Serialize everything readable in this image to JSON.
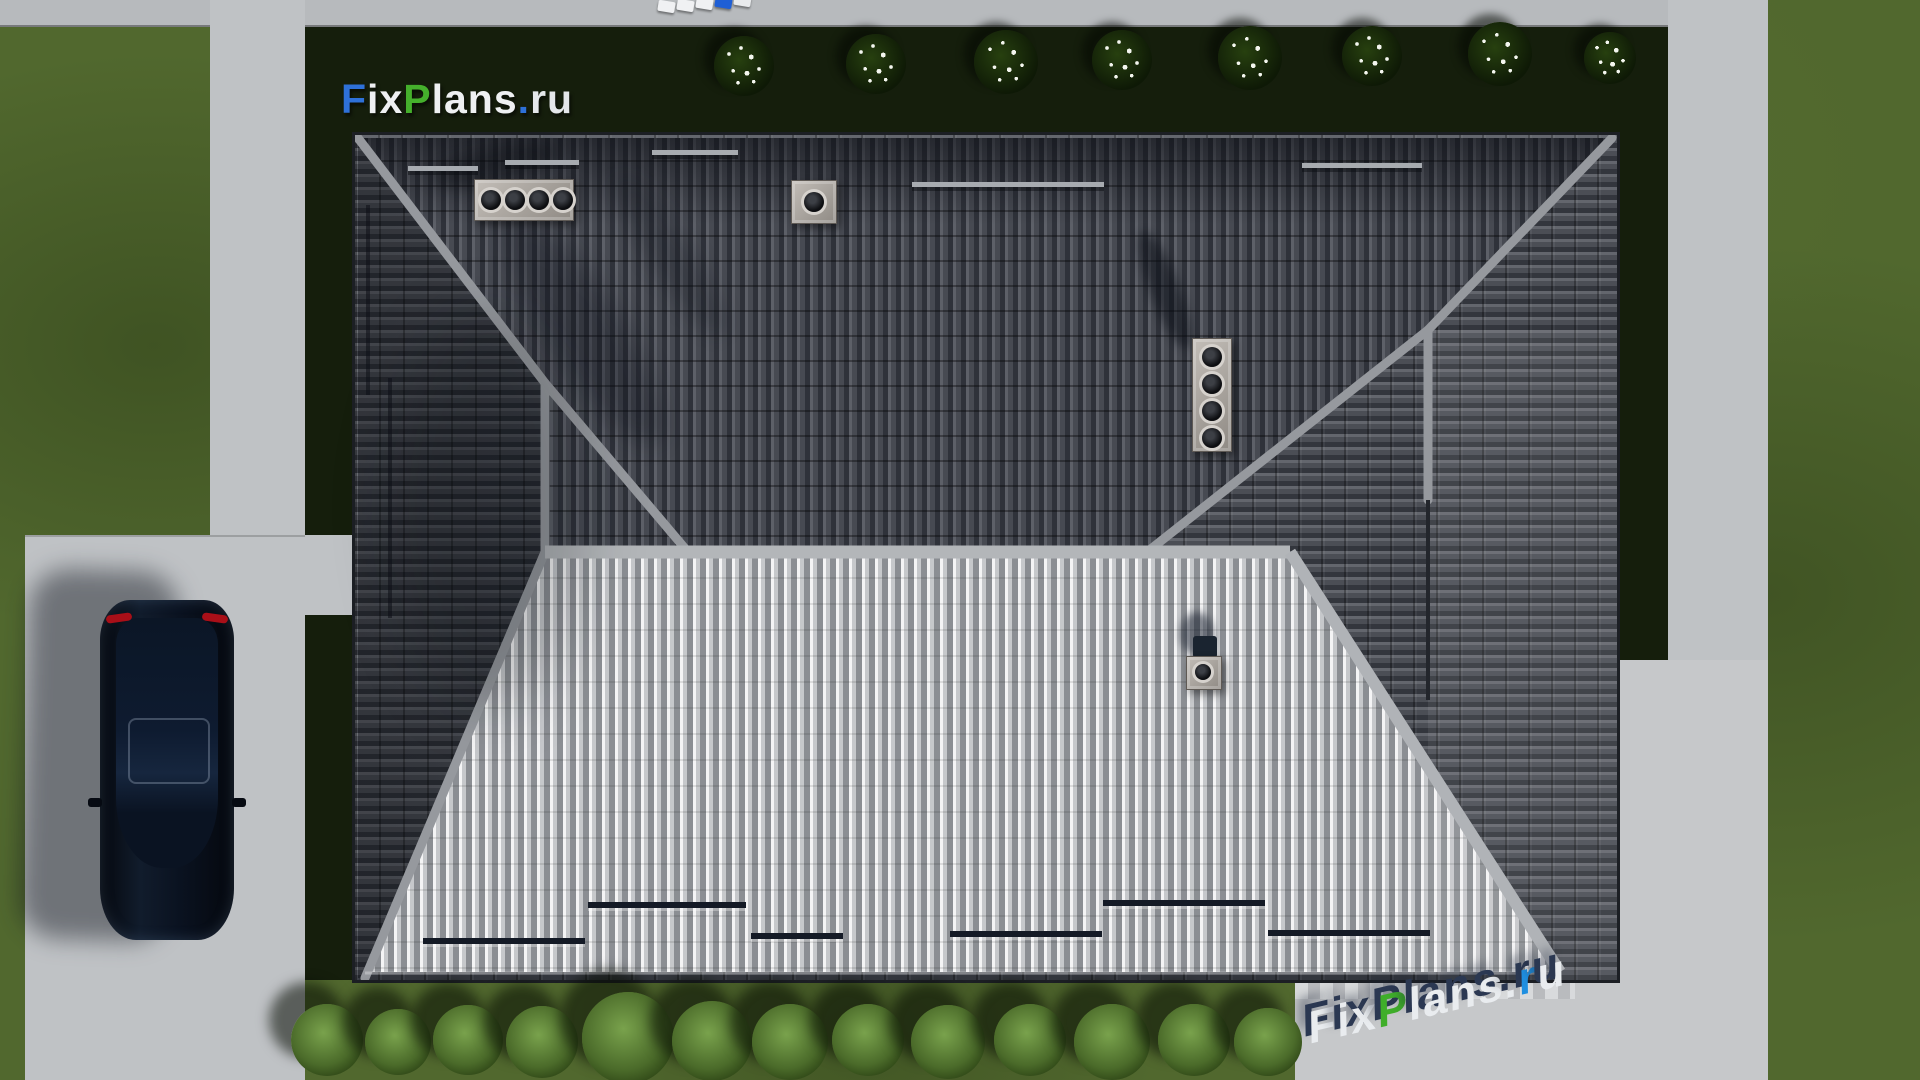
{
  "page": {
    "type": "aerial-architectural-render",
    "subject": "Top-down view of a hip-roof house with yard, driveway, parked car and concrete paths"
  },
  "branding": {
    "site_name": "FixPlans.ru",
    "main_logo": {
      "text": "FixPlans.ru",
      "segments": [
        {
          "text": "F",
          "color": "#2e71d9"
        },
        {
          "text": "ix",
          "color": "#eef0f2"
        },
        {
          "text": "P",
          "color": "#45b02c"
        },
        {
          "text": "lans",
          "color": "#eef0f2"
        },
        {
          "text": ".",
          "color": "#2e71d9"
        },
        {
          "text": "ru",
          "color": "#e4e7ea"
        }
      ]
    },
    "ground_watermark": {
      "text": "FixPlans.ru",
      "segments": [
        {
          "text": "F",
          "color": "#e9ecef"
        },
        {
          "text": "ix",
          "color": "#e9ecef"
        },
        {
          "text": "P",
          "color": "#3fae2a"
        },
        {
          "text": "lans",
          "color": "#e9ecef"
        },
        {
          "text": ".",
          "color": "#e9ecef"
        },
        {
          "text": "r",
          "color": "#1f8fe0"
        },
        {
          "text": "u",
          "color": "#e9ecef"
        }
      ]
    },
    "top_edge_watermark": {
      "blocks": [
        "#f0f1f3",
        "#f0f1f3",
        "#f0f1f3",
        "#1f5fd6",
        "#e8eaec"
      ]
    }
  },
  "palette": {
    "lawn": "#51682e",
    "lawn_shadow": "#151e0c",
    "road": "#b7babd",
    "driveway": "#c0c3c6",
    "patio": "#c6c8ca",
    "roof_dark": "#33363d",
    "roof_light": "#cdcfd2",
    "ridge": "#96999e",
    "car_body": "#0a0f17",
    "taillight": "#a90f18",
    "flowers": "#f4f6ef",
    "hedge": "#4b6b2a"
  },
  "scene": {
    "objects": [
      "hip roof with dark anthracite tiles",
      "sunlit light-grey south roof slope",
      "ridge and valley trims",
      "chimney with four flues",
      "single-flue roof vent",
      "vertical four-flue vent stack",
      "small roof ventilation outlet",
      "snow-guard bars",
      "black sedan parked on driveway",
      "concrete driveway and sidewalks",
      "back patio",
      "lawn with shadowed strips",
      "white flowering shrubs along top edge",
      "hedge of round bushes along bottom edge"
    ]
  }
}
